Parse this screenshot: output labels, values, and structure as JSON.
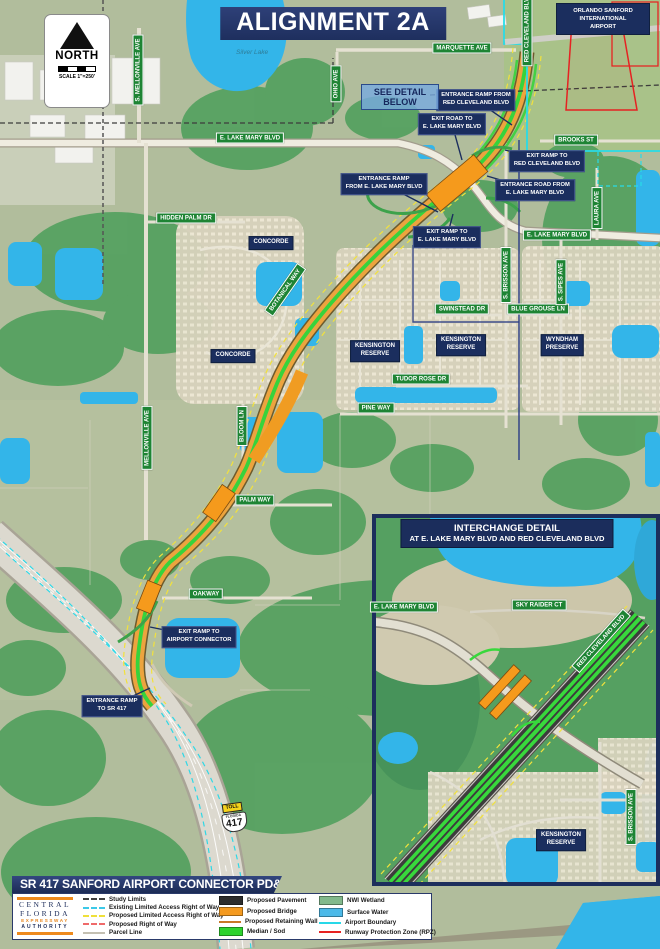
{
  "title": "ALIGNMENT 2A",
  "north_box": {
    "north": "NORTH",
    "scale": "SCALE 1\"=250'"
  },
  "see_detail_banner": "SEE DETAIL BELOW",
  "airport_label": [
    "ORLANDO SANFORD",
    "INTERNATIONAL",
    "AIRPORT"
  ],
  "water_label": "Silver Lake",
  "street_labels": [
    {
      "text": "E. LAKE MARY BLVD",
      "x": 250,
      "y": 138,
      "rot": 0
    },
    {
      "text": "MARQUETTE AVE",
      "x": 462,
      "y": 48,
      "rot": 0
    },
    {
      "text": "RED CLEVELAND BLVD",
      "x": 527,
      "y": 28,
      "rot": -90
    },
    {
      "text": "S. MELLONVILLE AVE",
      "x": 138,
      "y": 70,
      "rot": -90
    },
    {
      "text": "CSX R&R",
      "x": 104,
      "y": 86,
      "rot": -90
    },
    {
      "text": "OHIO AVE",
      "x": 336,
      "y": 84,
      "rot": -90
    },
    {
      "text": "BROOKS ST",
      "x": 576,
      "y": 140,
      "rot": 0
    },
    {
      "text": "E. LAKE MARY BLVD",
      "x": 557,
      "y": 235,
      "rot": 0
    },
    {
      "text": "LAURA AVE",
      "x": 597,
      "y": 208,
      "rot": -90
    },
    {
      "text": "HIDDEN PALM DR",
      "x": 186,
      "y": 218,
      "rot": 0
    },
    {
      "text": "BOTANICAL WAY",
      "x": 285,
      "y": 290,
      "rot": -55
    },
    {
      "text": "SWINSTEAD DR",
      "x": 462,
      "y": 309,
      "rot": 0
    },
    {
      "text": "BLUE GROUSE LN",
      "x": 538,
      "y": 309,
      "rot": 0
    },
    {
      "text": "S. BRISSON AVE",
      "x": 506,
      "y": 275,
      "rot": -90
    },
    {
      "text": "S. SIPES AVE",
      "x": 561,
      "y": 282,
      "rot": -90
    },
    {
      "text": "TUDOR ROSE DR",
      "x": 421,
      "y": 379,
      "rot": 0
    },
    {
      "text": "PINE WAY",
      "x": 376,
      "y": 408,
      "rot": 0
    },
    {
      "text": "BLOOM LN",
      "x": 242,
      "y": 426,
      "rot": -90
    },
    {
      "text": "MELLONVILLE AVE",
      "x": 147,
      "y": 438,
      "rot": -90
    },
    {
      "text": "PALM WAY",
      "x": 255,
      "y": 500,
      "rot": 0
    },
    {
      "text": "OAKWAY",
      "x": 206,
      "y": 594,
      "rot": 0
    }
  ],
  "inset_street_labels": [
    {
      "text": "E. LAKE MARY BLVD",
      "x": 404,
      "y": 607,
      "rot": 0
    },
    {
      "text": "SKY RAIDER CT",
      "x": 539,
      "y": 605,
      "rot": 0
    },
    {
      "text": "RED CLEVELAND BLVD",
      "x": 601,
      "y": 641,
      "rot": -48
    },
    {
      "text": "S. BRISSON AVE",
      "x": 631,
      "y": 817,
      "rot": -90
    }
  ],
  "place_labels": [
    {
      "lines": [
        "CONCORDE"
      ],
      "x": 271,
      "y": 243
    },
    {
      "lines": [
        "CONCORDE"
      ],
      "x": 233,
      "y": 356
    },
    {
      "lines": [
        "KENSINGTON",
        "RESERVE"
      ],
      "x": 375,
      "y": 351
    },
    {
      "lines": [
        "KENSINGTON",
        "RESERVE"
      ],
      "x": 461,
      "y": 345
    },
    {
      "lines": [
        "WYNDHAM",
        "PRESERVE"
      ],
      "x": 562,
      "y": 345
    },
    {
      "lines": [
        "KENSINGTON",
        "RESERVE"
      ],
      "x": 561,
      "y": 840
    }
  ],
  "callouts": [
    {
      "lines": [
        "ENTRANCE RAMP FROM",
        "RED CLEVELAND BLVD"
      ],
      "x": 476,
      "y": 100,
      "lx": 512,
      "ly": 125
    },
    {
      "lines": [
        "EXIT ROAD TO",
        "E. LAKE MARY BLVD"
      ],
      "x": 452,
      "y": 124,
      "lx": 462,
      "ly": 160
    },
    {
      "lines": [
        "EXIT RAMP TO",
        "RED CLEVELAND BLVD"
      ],
      "x": 547,
      "y": 161,
      "lx": 505,
      "ly": 150
    },
    {
      "lines": [
        "ENTRANCE ROAD FROM",
        "E. LAKE MARY BLVD"
      ],
      "x": 535,
      "y": 190,
      "lx": 487,
      "ly": 176
    },
    {
      "lines": [
        "ENTRANCE RAMP",
        "FROM E. LAKE MARY BLVD"
      ],
      "x": 384,
      "y": 184,
      "lx": 438,
      "ly": 212
    },
    {
      "lines": [
        "EXIT RAMP TO",
        "E. LAKE MARY BLVD"
      ],
      "x": 447,
      "y": 237,
      "lx": 453,
      "ly": 214
    },
    {
      "lines": [
        "EXIT RAMP TO",
        "AIRPORT CONNECTOR"
      ],
      "x": 199,
      "y": 637,
      "lx": 150,
      "ly": 627
    },
    {
      "lines": [
        "ENTRANCE RAMP",
        "TO SR 417"
      ],
      "x": 112,
      "y": 706,
      "lx": 150,
      "ly": 688
    }
  ],
  "inset": {
    "title": [
      "INTERCHANGE DETAIL",
      "AT E. LAKE MARY BLVD AND RED CLEVELAND BLVD"
    ]
  },
  "toll_shield": {
    "banner": "TOLL",
    "state": "FLORIDA",
    "number": "417"
  },
  "footer": {
    "banner": "SR 417 SANFORD AIRPORT CONNECTOR PD&E STUDY",
    "logo_lines": [
      "CENTRAL",
      "FLORIDA",
      "EXPRESSWAY",
      "AUTHORITY"
    ],
    "legend_columns": [
      {
        "items": [
          {
            "label": "Study Limits",
            "swatch": "line-dashed",
            "color": "#3f3f3f"
          },
          {
            "label": "Existing Limited Access Right of Way",
            "swatch": "line-dashed",
            "color": "#3cc9e8"
          },
          {
            "label": "Proposed Limited Access Right of Way",
            "swatch": "line-dashed",
            "color": "#efe03a"
          },
          {
            "label": "Proposed Right of Way",
            "swatch": "line-dashed",
            "color": "#ef6a6a"
          },
          {
            "label": "Parcel Line",
            "swatch": "line-solid",
            "color": "#c4c0b2"
          }
        ]
      },
      {
        "items": [
          {
            "label": "Proposed Pavement",
            "swatch": "rect",
            "color": "#2d2d2d"
          },
          {
            "label": "Proposed Bridge",
            "swatch": "rect",
            "color": "#f49a20"
          },
          {
            "label": "Proposed Retaining Wall",
            "swatch": "line-solid",
            "color": "#c87828"
          },
          {
            "label": "Median / Sod",
            "swatch": "rect",
            "color": "#2ed32e"
          }
        ]
      },
      {
        "items": [
          {
            "label": "NWI Wetland",
            "swatch": "rect",
            "color": "#82b98c"
          },
          {
            "label": "Surface Water",
            "swatch": "rect",
            "color": "#4cb9e8"
          },
          {
            "label": "Airport Boundary",
            "swatch": "line-solid",
            "color": "#28d8e8"
          },
          {
            "label": "Runway Protection Zone (RPZ)",
            "swatch": "line-solid",
            "color": "#e62222"
          }
        ]
      }
    ]
  },
  "colors": {
    "navy": "#1b2e5e",
    "label_green": "#1e8434",
    "water_blue": "#33b5e9",
    "wetland_green": "#4f9f5c",
    "bridge_orange": "#f59a1c",
    "median_green": "#37d33c",
    "rpz_red": "#e62222",
    "airport_cyan": "#28dbe8"
  }
}
